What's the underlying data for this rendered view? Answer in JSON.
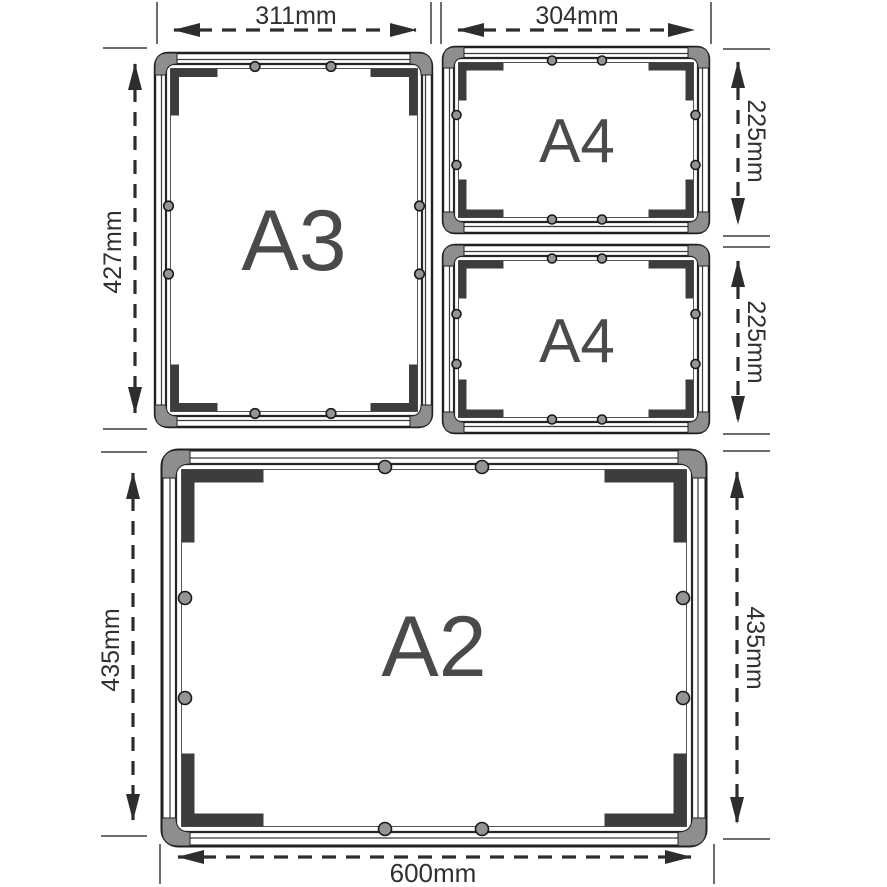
{
  "diagram": {
    "type": "snap-frame-size-diagram",
    "frames": {
      "a3": {
        "label": "A3"
      },
      "a4_top": {
        "label": "A4"
      },
      "a4_bottom": {
        "label": "A4"
      },
      "a2": {
        "label": "A2"
      }
    },
    "dimensions": {
      "a3_width": "311mm",
      "a3_height": "427mm",
      "a4_width": "304mm",
      "a4_top_height": "225mm",
      "a4_bottom_height": "225mm",
      "a2_width": "600mm",
      "a2_height_left": "435mm",
      "a2_height_right": "435mm"
    },
    "colors": {
      "line": "#1f1f1f",
      "corner_cap": "#8e8e8e",
      "clamp": "#3d3d3d",
      "screw": "#949494",
      "dimension": "#2d2d2d",
      "label_text": "#4a4a4a"
    }
  }
}
